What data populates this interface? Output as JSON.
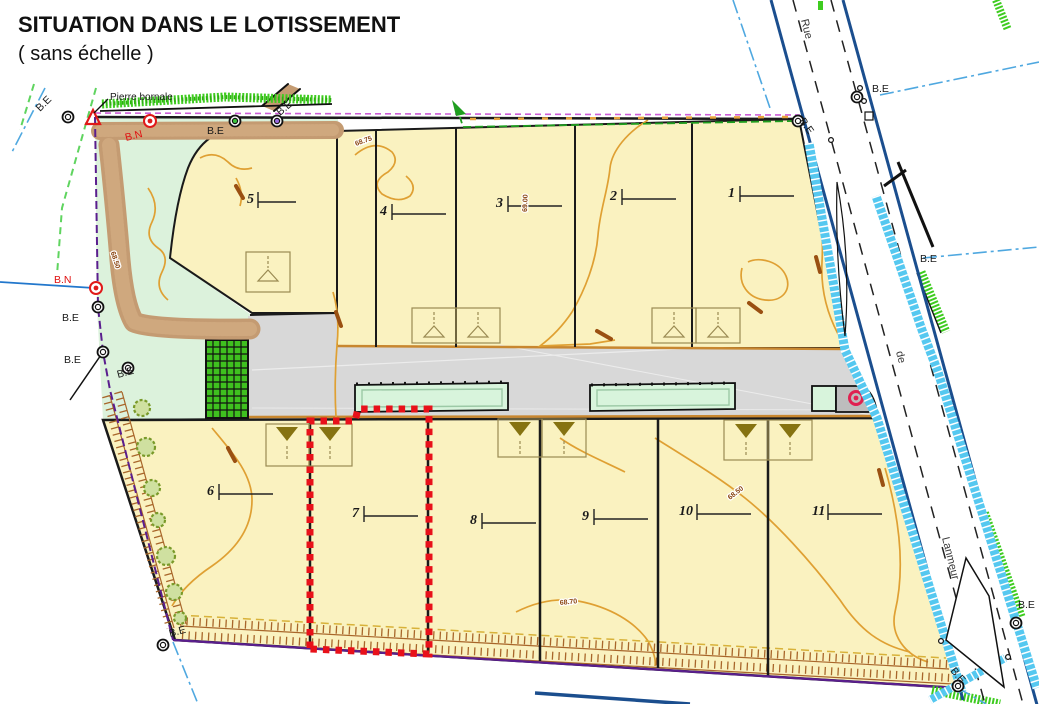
{
  "title": {
    "main": "SITUATION DANS LE LOTISSEMENT",
    "sub": "( sans échelle )"
  },
  "labels": {
    "pierre_bornale": "Pierre bornale",
    "be": "B.E",
    "bn": "B.N"
  },
  "street": {
    "part1": "Rue",
    "part2": "de",
    "part3": "Lanmeur"
  },
  "lots": {
    "numbers": [
      "1",
      "2",
      "3",
      "4",
      "5",
      "6",
      "7",
      "8",
      "9",
      "10",
      "11"
    ],
    "highlighted_lot": "7"
  },
  "contours": {
    "elevations": [
      "68.75",
      "69.00",
      "68.50",
      "68.50",
      "68.70"
    ]
  },
  "colors": {
    "lot_fill": "#FAF2C0",
    "green_space": "#DCF2DC",
    "road": "#D8D8D8",
    "hedge": "#3ECC1F",
    "water_channel": "#55C8F0",
    "street_edge": "#1B4E8E",
    "boundary": "#5A1E8E",
    "contour": "#DFA033",
    "highlight": "#E8111A",
    "talus": "#A8662A"
  }
}
